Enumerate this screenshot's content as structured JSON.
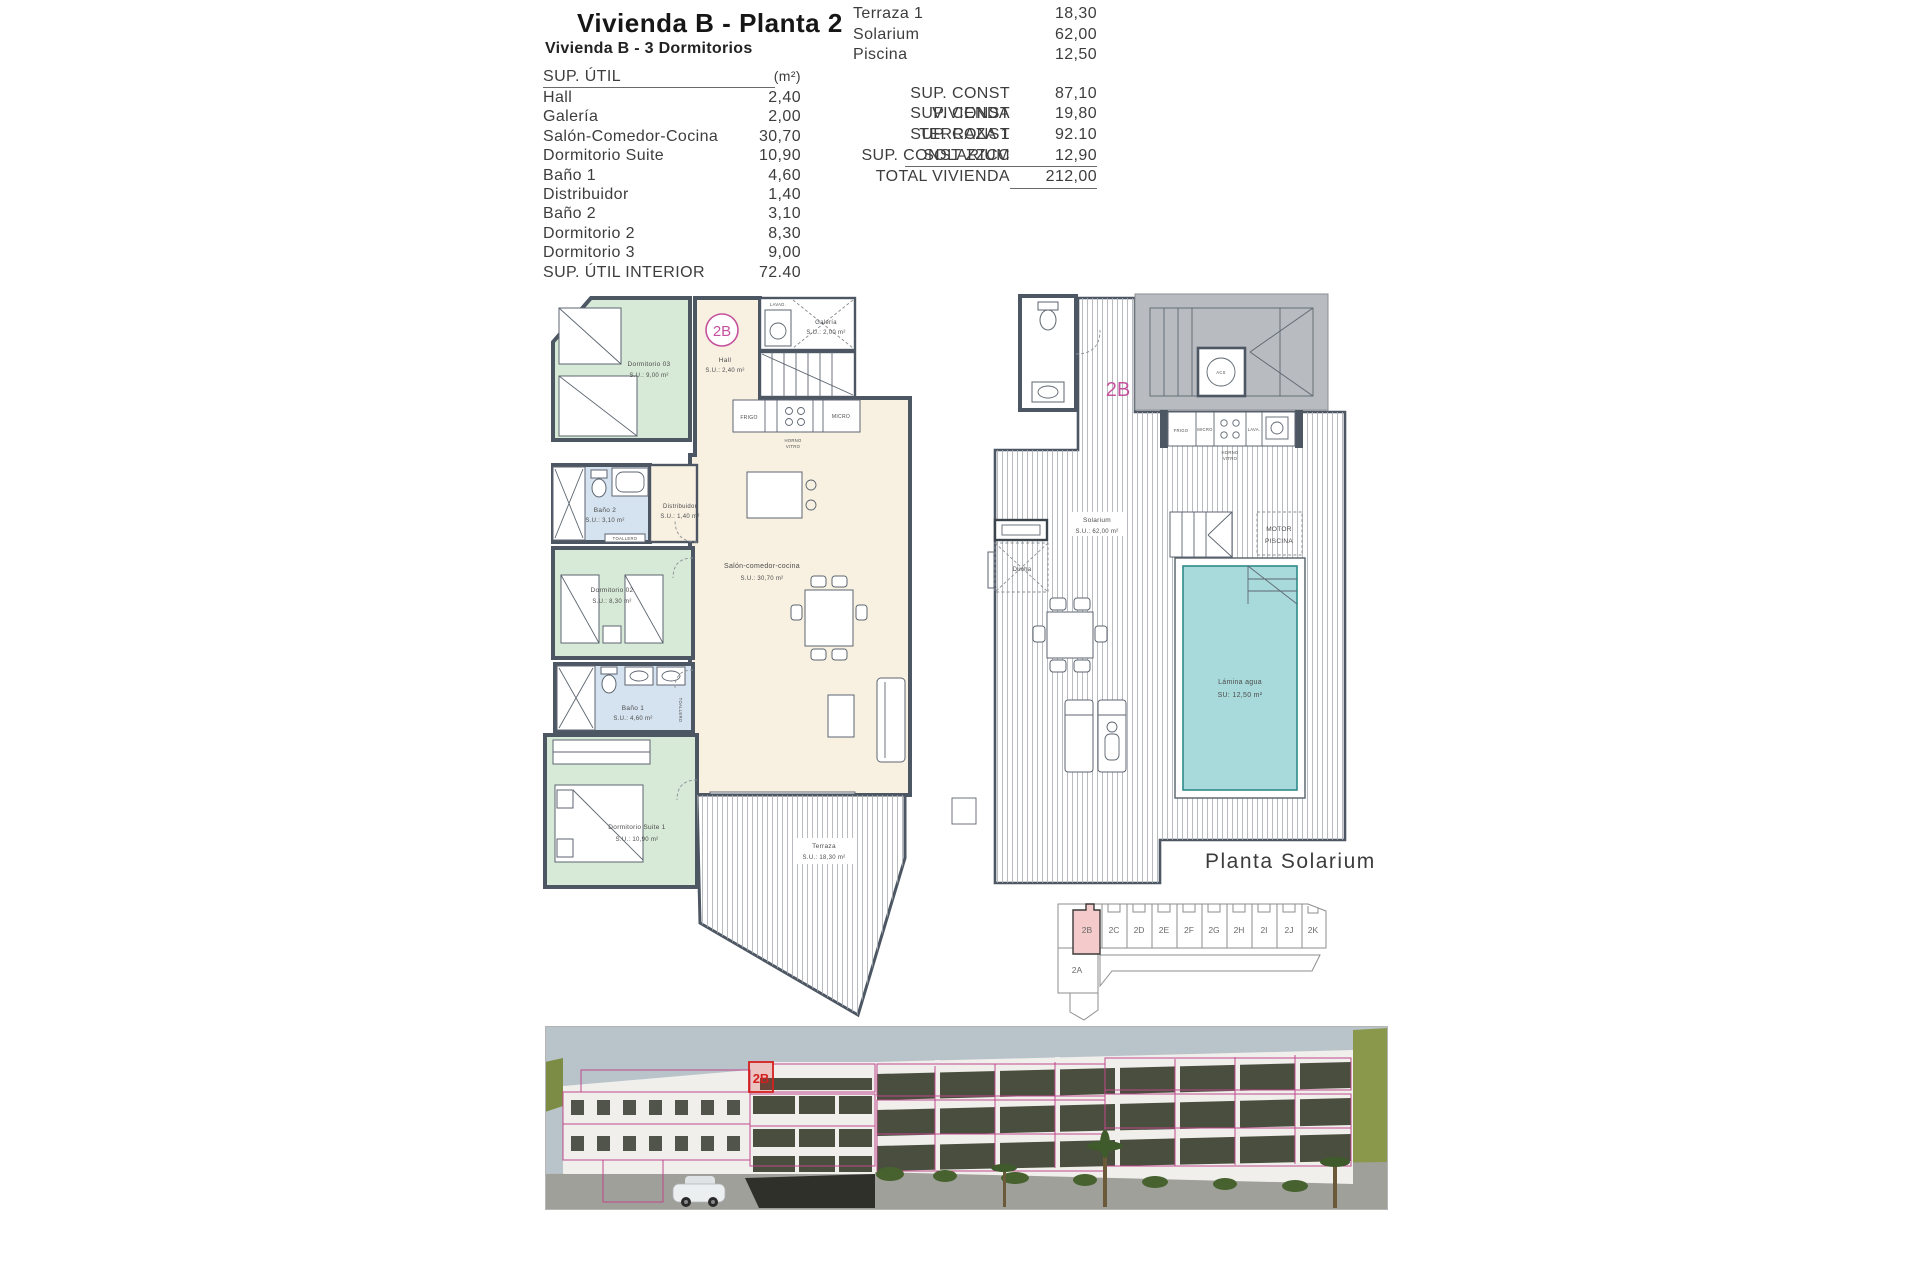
{
  "page": {
    "title": "Vivienda B - Planta 2",
    "subtitle": "Vivienda B - 3 Dormitorios"
  },
  "sup_util": {
    "header": "SUP. ÚTIL",
    "unit": "(m²)",
    "rows": [
      {
        "label": "Hall",
        "value": "2,40"
      },
      {
        "label": "Galería",
        "value": "2,00"
      },
      {
        "label": "Salón-Comedor-Cocina",
        "value": "30,70"
      },
      {
        "label": "Dormitorio Suite",
        "value": "10,90"
      },
      {
        "label": "Baño 1",
        "value": "4,60"
      },
      {
        "label": "Distribuidor",
        "value": "1,40"
      },
      {
        "label": "Baño 2",
        "value": "3,10"
      },
      {
        "label": "Dormitorio 2",
        "value": "8,30"
      },
      {
        "label": "Dormitorio 3",
        "value": "9,00"
      }
    ],
    "total_label": "SUP. ÚTIL INTERIOR",
    "total_value": "72.40"
  },
  "sup_const": {
    "exterior": [
      {
        "label": "Terraza 1",
        "value": "18,30"
      },
      {
        "label": "Solarium",
        "value": "62,00"
      },
      {
        "label": "Piscina",
        "value": "12,50"
      }
    ],
    "rows": [
      {
        "label": "SUP. CONST VIVIENDA",
        "value": "87,10"
      },
      {
        "label": "SUP. CONST TERRAZA 1",
        "value": "19,80"
      },
      {
        "label": "SUP. CONST SOLARIUM",
        "value": "92.10"
      },
      {
        "label": "SUP. CONST ZZCC",
        "value": "12,90"
      }
    ],
    "total_label": "TOTAL VIVIENDA",
    "total_value": "212,00"
  },
  "plan": {
    "unit": "2B",
    "rooms": {
      "dorm3_name": "Dormitorio 03",
      "dorm3_area": "S.U.: 9,00 m²",
      "hall_name": "Hall",
      "hall_area": "S.U.: 2,40 m²",
      "galeria_name": "Galería",
      "galeria_area": "S.U.: 2,00 m²",
      "bano2_name": "Baño 2",
      "bano2_area": "S.U.: 3,10 m²",
      "distribuidor_name": "Distribuidor",
      "distribuidor_area": "S.U.: 1,40 m²",
      "dorm2_name": "Dormitorio 02",
      "dorm2_area": "S.U.: 8,30 m²",
      "bano1_name": "Baño 1",
      "bano1_area": "S.U.: 4,60 m²",
      "salon_name": "Salón-comedor-cocina",
      "salon_area": "S.U.: 30,70 m²",
      "suite_name": "Dormitorio Suite 1",
      "suite_area": "S.U.: 10,90 m²",
      "terraza_name": "Terraza",
      "terraza_area": "S.U.: 18,30 m²"
    },
    "fixtures": {
      "toallero": "TOALLERO",
      "frigo": "FRIGO",
      "micro": "MICRO",
      "horno": "HORNO",
      "vitro": "VITRO",
      "lavad": "LAVAD."
    }
  },
  "solarium": {
    "unit": "2B",
    "caption": "Planta Solarium",
    "solarium_name": "Solarium",
    "solarium_area": "S.U.: 62,00 m²",
    "pool_name": "Lámina agua",
    "pool_area": "SU:   12,50 m²",
    "ducha": "Ducha",
    "motor_line1": "MOTOR",
    "motor_line2": "PISCINA",
    "acs": "ACS",
    "kitchen": {
      "frigo": "FRIGO",
      "micro": "MICRO",
      "horno": "HORNO",
      "vitro": "VITRO",
      "lava": "LAVA."
    }
  },
  "units_key": {
    "row": [
      "2B",
      "2C",
      "2D",
      "2E",
      "2F",
      "2G",
      "2H",
      "2I",
      "2J",
      "2K"
    ],
    "below": "2A"
  },
  "render": {
    "unit": "2B"
  },
  "colors": {
    "accent_pink": "#c5529c",
    "grid_pink": "#c0488c",
    "highlight_red": "#d42020",
    "room_green": "#d7e9d7",
    "room_blue": "#d5e3f0",
    "room_cream": "#f8f1e2",
    "pool_teal": "#a9dadb",
    "wall": "#4d5763"
  }
}
